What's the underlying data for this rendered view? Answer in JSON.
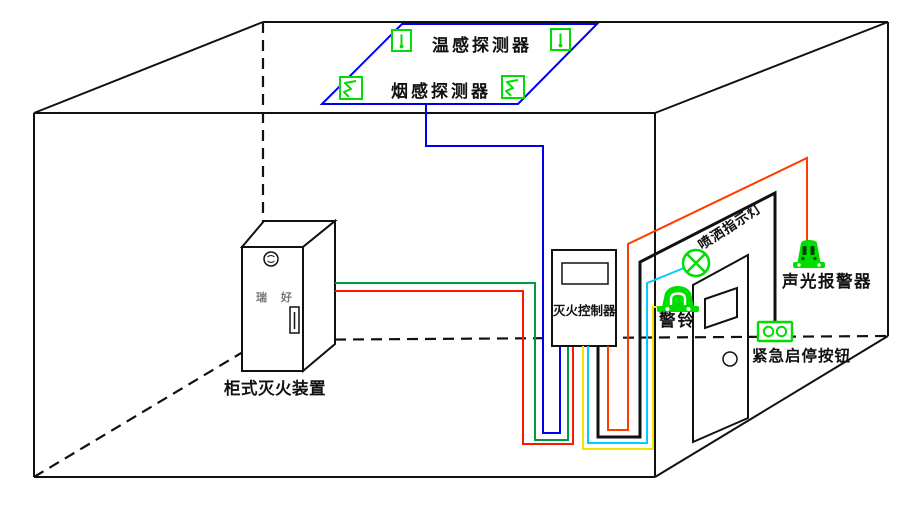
{
  "diagram": {
    "labels": {
      "temp_detector": "温感探测器",
      "smoke_detector": "烟感探测器",
      "controller": "灭火控制器",
      "cabinet": "柜式灭火装置",
      "cabinet_brand": "瑞 好",
      "spray_indicator": "喷洒指示灯",
      "alarm_bell": "警铃",
      "sound_light_alarm": "声光报警器",
      "emergency_button": "紧急启停按钮"
    },
    "icons": {
      "temp_detector_icon": "probe-in-square",
      "smoke_detector_icon": "s-curve-in-square",
      "spray_indicator_icon": "circle-cross-lamp",
      "alarm_bell_icon": "bell-dome",
      "sound_light_alarm_icon": "strobe-horn",
      "emergency_button_icon": "two-button-plate",
      "cabinet_logo_icon": "round-emblem"
    },
    "colors": {
      "outline": "#111111",
      "zone_blue": "#0000ee",
      "wire_blue": "#0000ee",
      "wire_green": "#009944",
      "wire_red": "#ff1500",
      "wire_orange_red": "#ff3c00",
      "wire_cyan": "#00ccff",
      "wire_yellow": "#f2e400",
      "wire_black": "#111111",
      "device_green": "#00dd00"
    }
  }
}
